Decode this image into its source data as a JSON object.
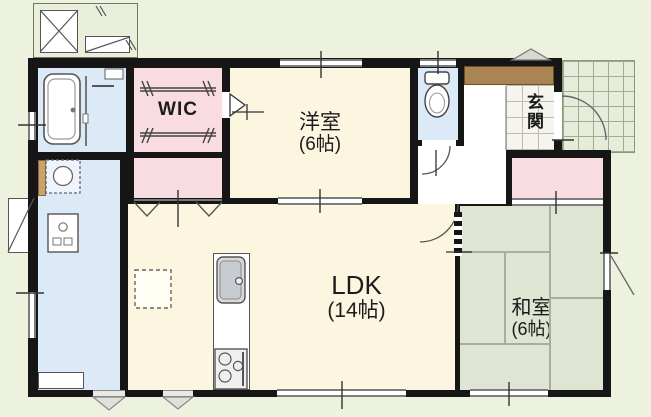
{
  "rooms": {
    "wic": {
      "label": "WIC"
    },
    "western_room": {
      "label": "洋室",
      "size": "(6帖)"
    },
    "entrance": {
      "label": "玄関"
    },
    "ldk": {
      "label": "LDK",
      "size": "(14帖)"
    },
    "japanese_room": {
      "label": "和室",
      "size": "(6帖)"
    }
  },
  "colors": {
    "outside": "#edf2de",
    "wall": "#161616",
    "wood_floor": "#fcf5e0",
    "closet_pink": "#f9dce1",
    "wet_area_blue": "#dceaf7",
    "tatami_green": "#dfe5d3",
    "entrance_tile": "#f5f4ee",
    "porch_tile": "#e7ecda",
    "cabinet_brown": "#ab8453"
  }
}
